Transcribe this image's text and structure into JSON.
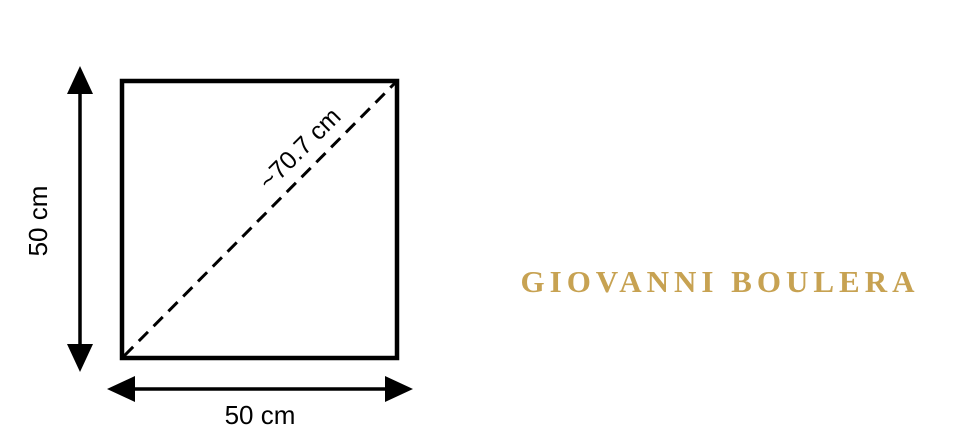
{
  "diagram": {
    "shape": "square",
    "height_label": "50 cm",
    "width_label": "50 cm",
    "diagonal_label": "~70.7 cm",
    "line_color": "#000000",
    "background": "#FFFFFF"
  },
  "brand": {
    "name": "GIOVANNI BOULERA",
    "color": "#C7A252"
  }
}
